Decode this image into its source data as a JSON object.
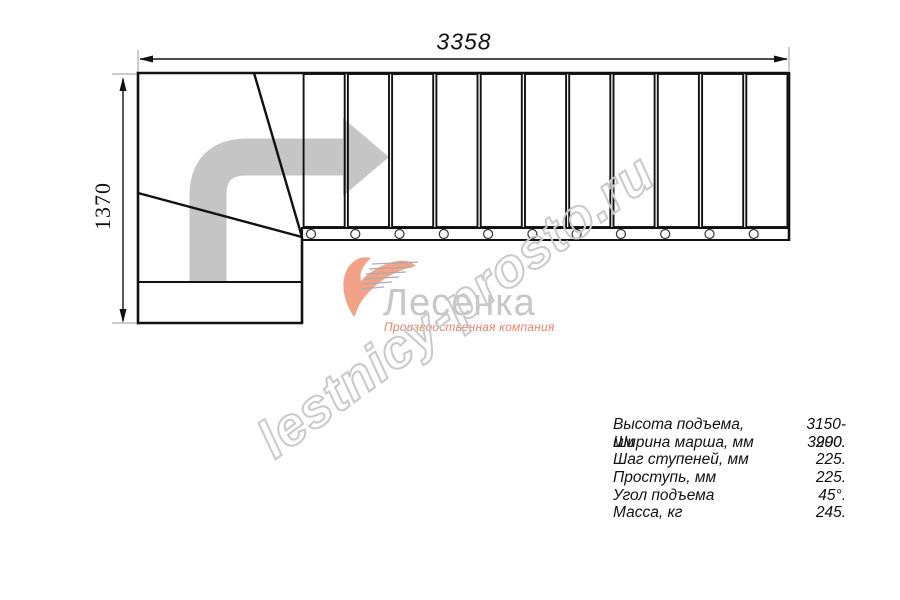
{
  "drawing": {
    "dim_width": "3358",
    "dim_height": "1370",
    "tread_count": 11
  },
  "logo": {
    "name": "Лесенка",
    "tagline": "Производственная компания",
    "accent_color": "#f2a287",
    "tagline_color": "#e8836b"
  },
  "watermark": {
    "text": "lestnicy-prosto.ru"
  },
  "specs": {
    "rows": [
      {
        "label": "Высота подъема, мм",
        "value": "3150-3290."
      },
      {
        "label": "Ширина марша, мм",
        "value": "900."
      },
      {
        "label": "Шаг ступеней, мм",
        "value": "225."
      },
      {
        "label": "Проступь, мм",
        "value": "225."
      },
      {
        "label": "Угол подъема",
        "value": "45°."
      },
      {
        "label": "Масса, кг",
        "value": "245."
      }
    ]
  }
}
